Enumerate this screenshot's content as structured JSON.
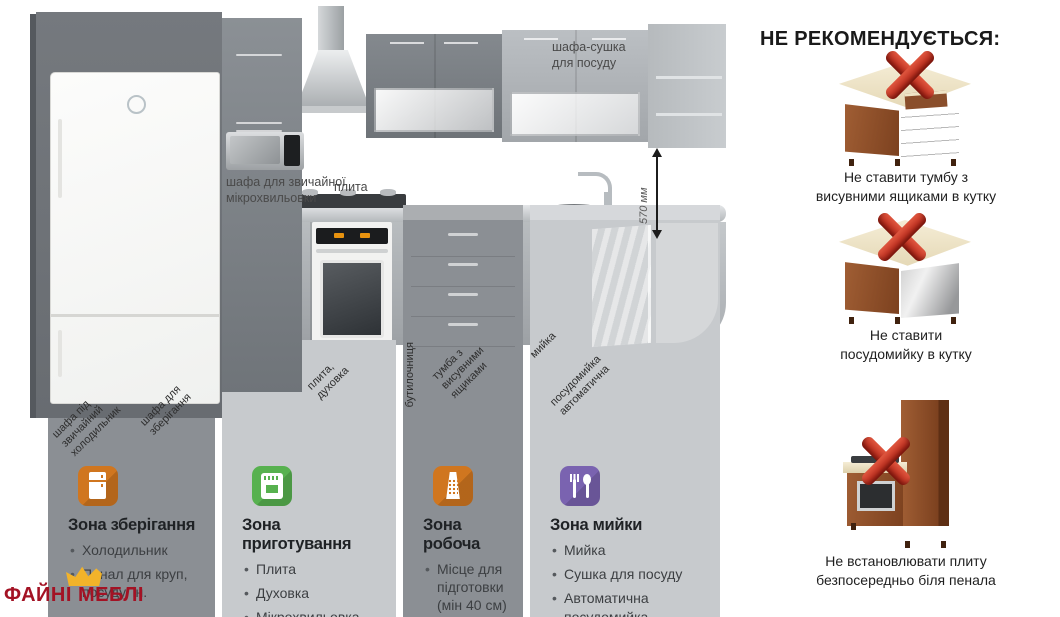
{
  "kitchen": {
    "labels": {
      "dish_dryer": "шафа-сушка\nдля посуду",
      "microwave": "шафа для звичайної\nмікрохвильовки",
      "hob": "плита",
      "height": "570 мм",
      "fridge_cabinet": "шафа під\nзвичайний\nхолодильник",
      "storage_cabinet": "шафа для\nзберігання",
      "hob_oven": "плита,\nдуховка",
      "bottle_rack": "бутилочниця",
      "drawer_unit": "тумба з\nвисувними\nящиками",
      "sink": "мийка",
      "dishwasher": "посудомийка\nавтоматична"
    }
  },
  "zones": [
    {
      "icon": "fridge-icon",
      "icon_color": "#d0761f",
      "title": "Зона зберігання",
      "items": [
        "Холодильник",
        "Пенал для круп, посуду, ін."
      ]
    },
    {
      "icon": "oven-icon",
      "icon_color": "#57b14f",
      "title": "Зона приготування",
      "items": [
        "Плита",
        "Духовка",
        "Мікрохвильовка"
      ]
    },
    {
      "icon": "grater-icon",
      "icon_color": "#d0761f",
      "title": "Зона робоча",
      "items": [
        "Місце для підготовки (мін 40 см)"
      ]
    },
    {
      "icon": "cutlery-icon",
      "icon_color": "#7a63b0",
      "title": "Зона мийки",
      "items": [
        "Мийка",
        "Сушка для посуду",
        "Автоматична посудомийка"
      ]
    }
  ],
  "not_recommended": {
    "heading": "НЕ РЕКОМЕНДУЄТЬСЯ:",
    "items": [
      {
        "image": "corner-cabinet-with-drawers",
        "caption": "Не ставити тумбу з\nвисувними ящиками в кутку"
      },
      {
        "image": "corner-dishwasher",
        "caption": "Не ставити\nпосудомийку в кутку"
      },
      {
        "image": "stove-next-to-tall-pantry",
        "caption": "Не встановлювати плиту\nбезпосередньо біля пенала"
      }
    ]
  },
  "brand": {
    "name": "ФАЙНІ МЕБЛІ"
  },
  "colors": {
    "column_dark": "#8b8f94",
    "column_light": "#c7cacd",
    "forbidden_x": "#c9281c",
    "brand_red": "#a31224",
    "crown_gold": "#f2b32a"
  }
}
